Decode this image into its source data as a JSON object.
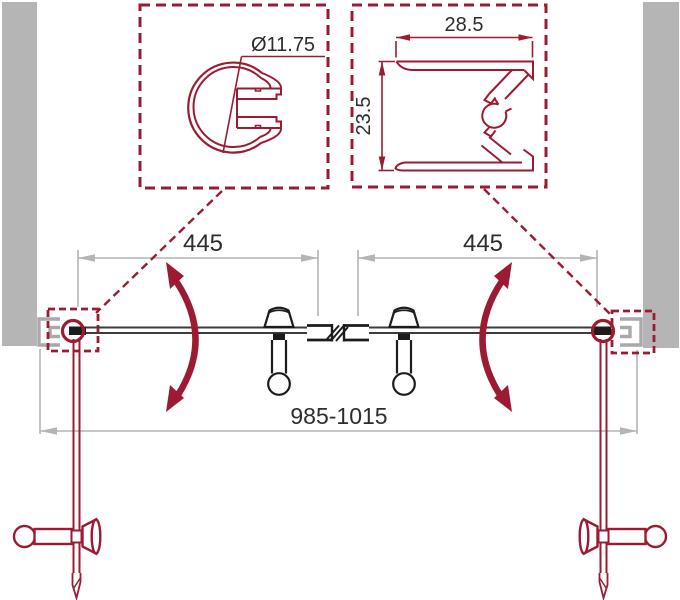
{
  "details": {
    "pivot": {
      "diameter_label": "Ø11.75"
    },
    "wall_profile": {
      "width_label": "28.5",
      "depth_label": "23.5"
    }
  },
  "plan": {
    "left_panel_width": "445",
    "right_panel_width": "445",
    "overall_width_range": "985-1015"
  },
  "colors": {
    "accent_red": "#9c1b32",
    "wall_gray": "#b5b5b5",
    "dimension_gray": "#b4b4b4",
    "ink_black": "#1c1c1c"
  }
}
